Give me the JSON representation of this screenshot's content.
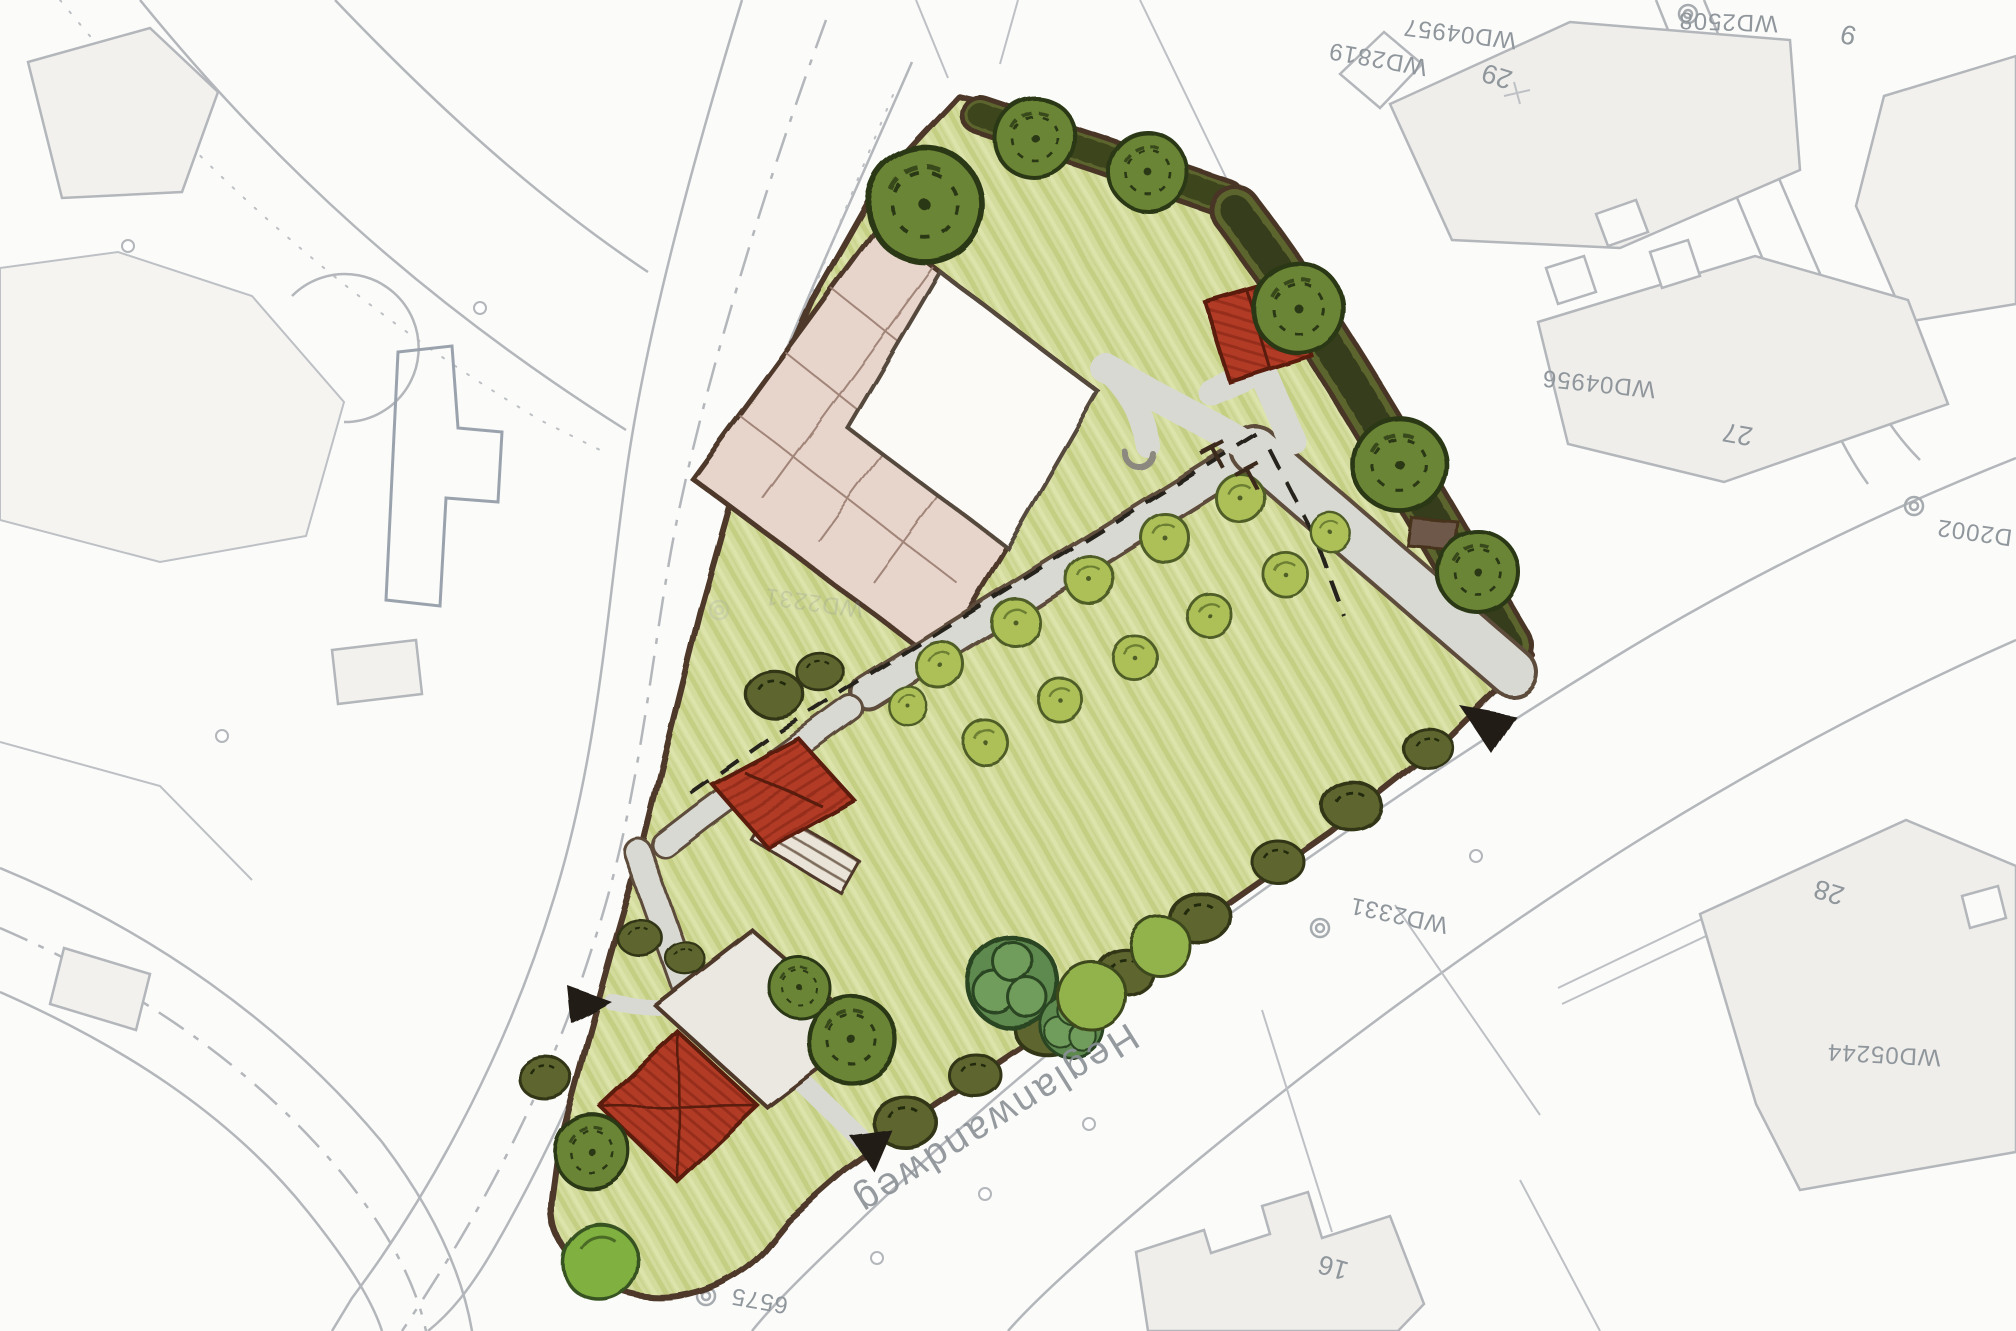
{
  "document": {
    "type": "Scanned hand-drawn landscape site plan (colored pencil) over a cadastral base map",
    "orientation_note": "All base-map labels are printed rotated 180 degrees (map is upside down relative to text)"
  },
  "street": {
    "name": "Heglanwandweg"
  },
  "labels": {
    "wd2508": "WD2508",
    "wd2819": "WD2819",
    "wd04957": "WD04957",
    "wd04956": "WD04956",
    "d2002": "D2002",
    "wd05244": "WD05244",
    "wd2331": "WD2331",
    "point_6575": "6575",
    "faint_under_sketch": "WD2231"
  },
  "house_numbers": {
    "n29": "29",
    "n27": "27",
    "n28": "28",
    "n16": "16",
    "n9": "9"
  },
  "colors": {
    "roof_red": "#b23b26",
    "hedge_green": "#5c652d",
    "path_gray": "#d8d9d2",
    "arrow_black": "#201d19",
    "lawn_green": "#d3db9d",
    "terrace_pink": "#e7d4cb",
    "label_gray": "#8f969c"
  }
}
